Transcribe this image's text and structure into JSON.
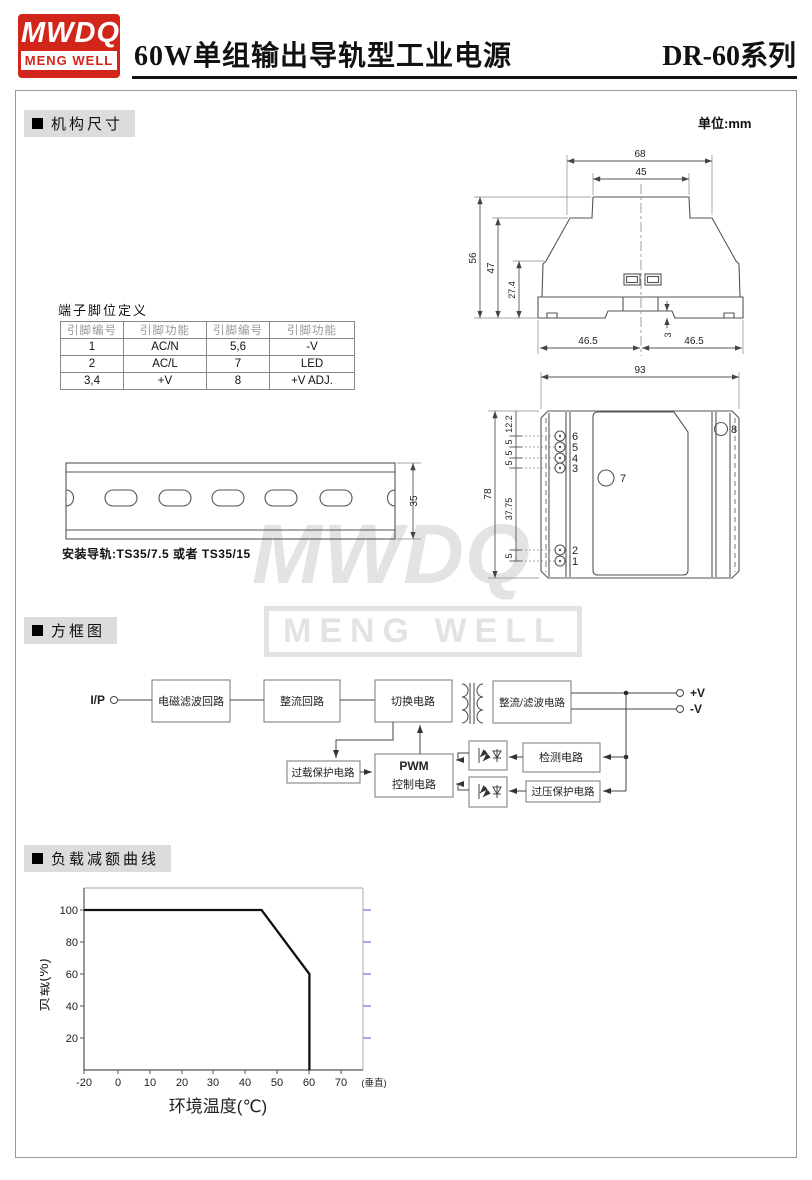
{
  "colors": {
    "brand_red": "#d3261a",
    "watermark_gray": "#e3e3e3",
    "tick_blue": "#8585ee",
    "curve_black": "#111111"
  },
  "header": {
    "logo_top": "MWDQ",
    "logo_bottom": "MENG WELL",
    "title": "60W单组输出导轨型工业电源",
    "series": "DR-60系列"
  },
  "sections": {
    "mech": "机构尺寸",
    "block": "方框图",
    "derating": "负载减额曲线"
  },
  "mech": {
    "unit": "单位:mm",
    "top_view": {
      "w_outer": "68",
      "w_inner": "45",
      "h_total": "56",
      "h_body": "47",
      "h_lower": "27.4",
      "half_left": "46.5",
      "half_right": "46.5",
      "notch": "3"
    },
    "front_view": {
      "width": "93",
      "height": "78",
      "seg_12_2": "12.2",
      "seg_5a": "5",
      "seg_5b": "5",
      "seg_5c": "5",
      "seg_37_75": "37.75",
      "seg_5d": "5",
      "pin6": "6",
      "pin5": "5",
      "pin4": "4",
      "pin3": "3",
      "pin2": "2",
      "pin1": "1",
      "pin7": "7",
      "pin8": "8"
    },
    "rail": {
      "height": "35",
      "note": "安装导轨:TS35/7.5 或者 TS35/15"
    }
  },
  "pin_table": {
    "title": "端子脚位定义",
    "headers": [
      "引脚编号",
      "引脚功能",
      "引脚编号",
      "引脚功能"
    ],
    "rows": [
      [
        "1",
        "AC/N",
        "5,6",
        "-V"
      ],
      [
        "2",
        "AC/L",
        "7",
        "LED"
      ],
      [
        "3,4",
        "+V",
        "8",
        "+V ADJ."
      ]
    ]
  },
  "block_diagram": {
    "input": "I/P",
    "emi": "电磁滤波回路",
    "rectifier": "整流回路",
    "switching": "切换电路",
    "rect_filter": "整流/滤波电路",
    "out_pos": "+V",
    "out_neg": "-V",
    "overload": "过载保护电路",
    "pwm_line1": "PWM",
    "pwm_line2": "控制电路",
    "detect": "检测电路",
    "ovp": "过压保护电路"
  },
  "watermark": {
    "line1": "MWDQ",
    "line2": "MENG WELL"
  },
  "chart_data": {
    "type": "line",
    "title": "负载减额曲线",
    "xlabel": "环境温度(℃)",
    "ylabel": "负载(%)",
    "x_ticks": [
      "-20",
      "0",
      "10",
      "20",
      "30",
      "40",
      "50",
      "60",
      "70",
      "(垂直)"
    ],
    "y_ticks": [
      "20",
      "40",
      "60",
      "80",
      "100"
    ],
    "xlim": [
      -20,
      80
    ],
    "ylim": [
      0,
      110
    ],
    "grid": false,
    "legend": false,
    "series": [
      {
        "name": "负载",
        "points": [
          [
            -20,
            100
          ],
          [
            45,
            100
          ],
          [
            60,
            60
          ],
          [
            60,
            0
          ]
        ]
      }
    ]
  }
}
